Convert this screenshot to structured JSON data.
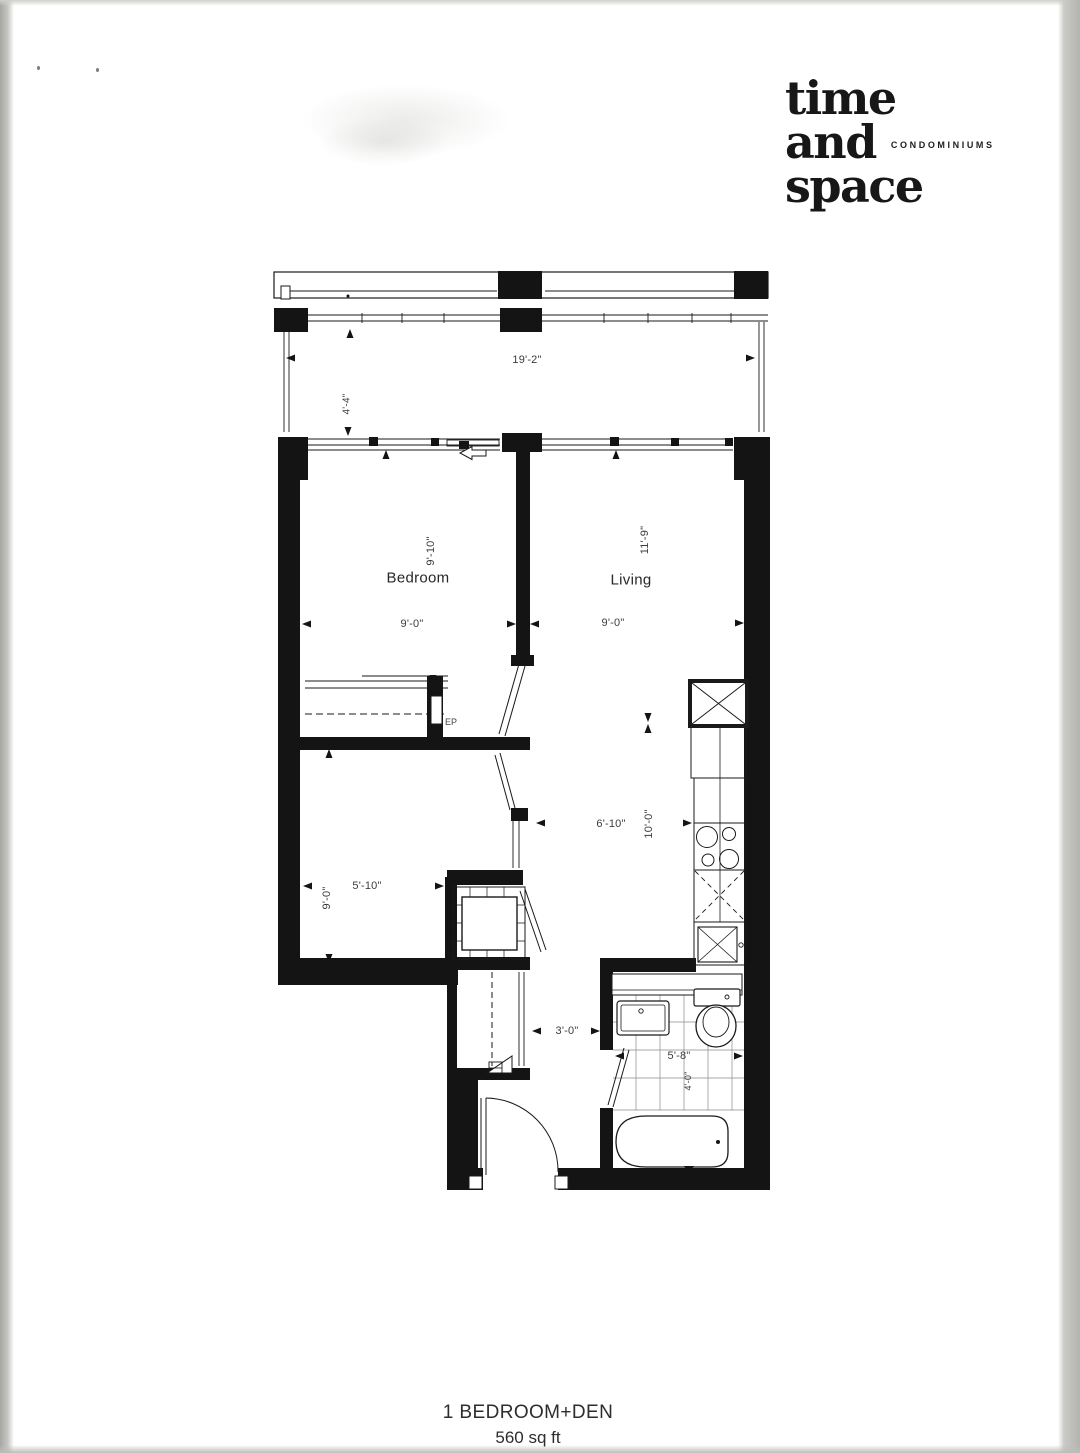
{
  "logo": {
    "word1": "time",
    "word2": "and",
    "word3": "space",
    "tagline": "CONDOMINIUMS"
  },
  "plan": {
    "rooms": {
      "balcony": {
        "width": "19'-2\"",
        "depth": "4'-4\""
      },
      "bedroom": {
        "name": "Bedroom",
        "width": "9'-0\"",
        "depth": "9'-10\""
      },
      "living": {
        "name": "Living",
        "width": "9'-0\"",
        "depth": "11'-9\""
      },
      "den": {
        "width": "5'-10\"",
        "depth": "9'-0\""
      },
      "kitchen": {
        "width": "6'-10\"",
        "depth": "10'-0\""
      },
      "hall": {
        "width": "3'-0\""
      },
      "bath": {
        "width": "5'-8\"",
        "depth": "4'-0\""
      }
    },
    "labels": {
      "electrical_panel": "EP"
    }
  },
  "footer": {
    "unit_type": "1 BEDROOM+DEN",
    "area": "560 sq ft"
  },
  "colors": {
    "ink": "#141414",
    "paper": "#ffffff"
  }
}
